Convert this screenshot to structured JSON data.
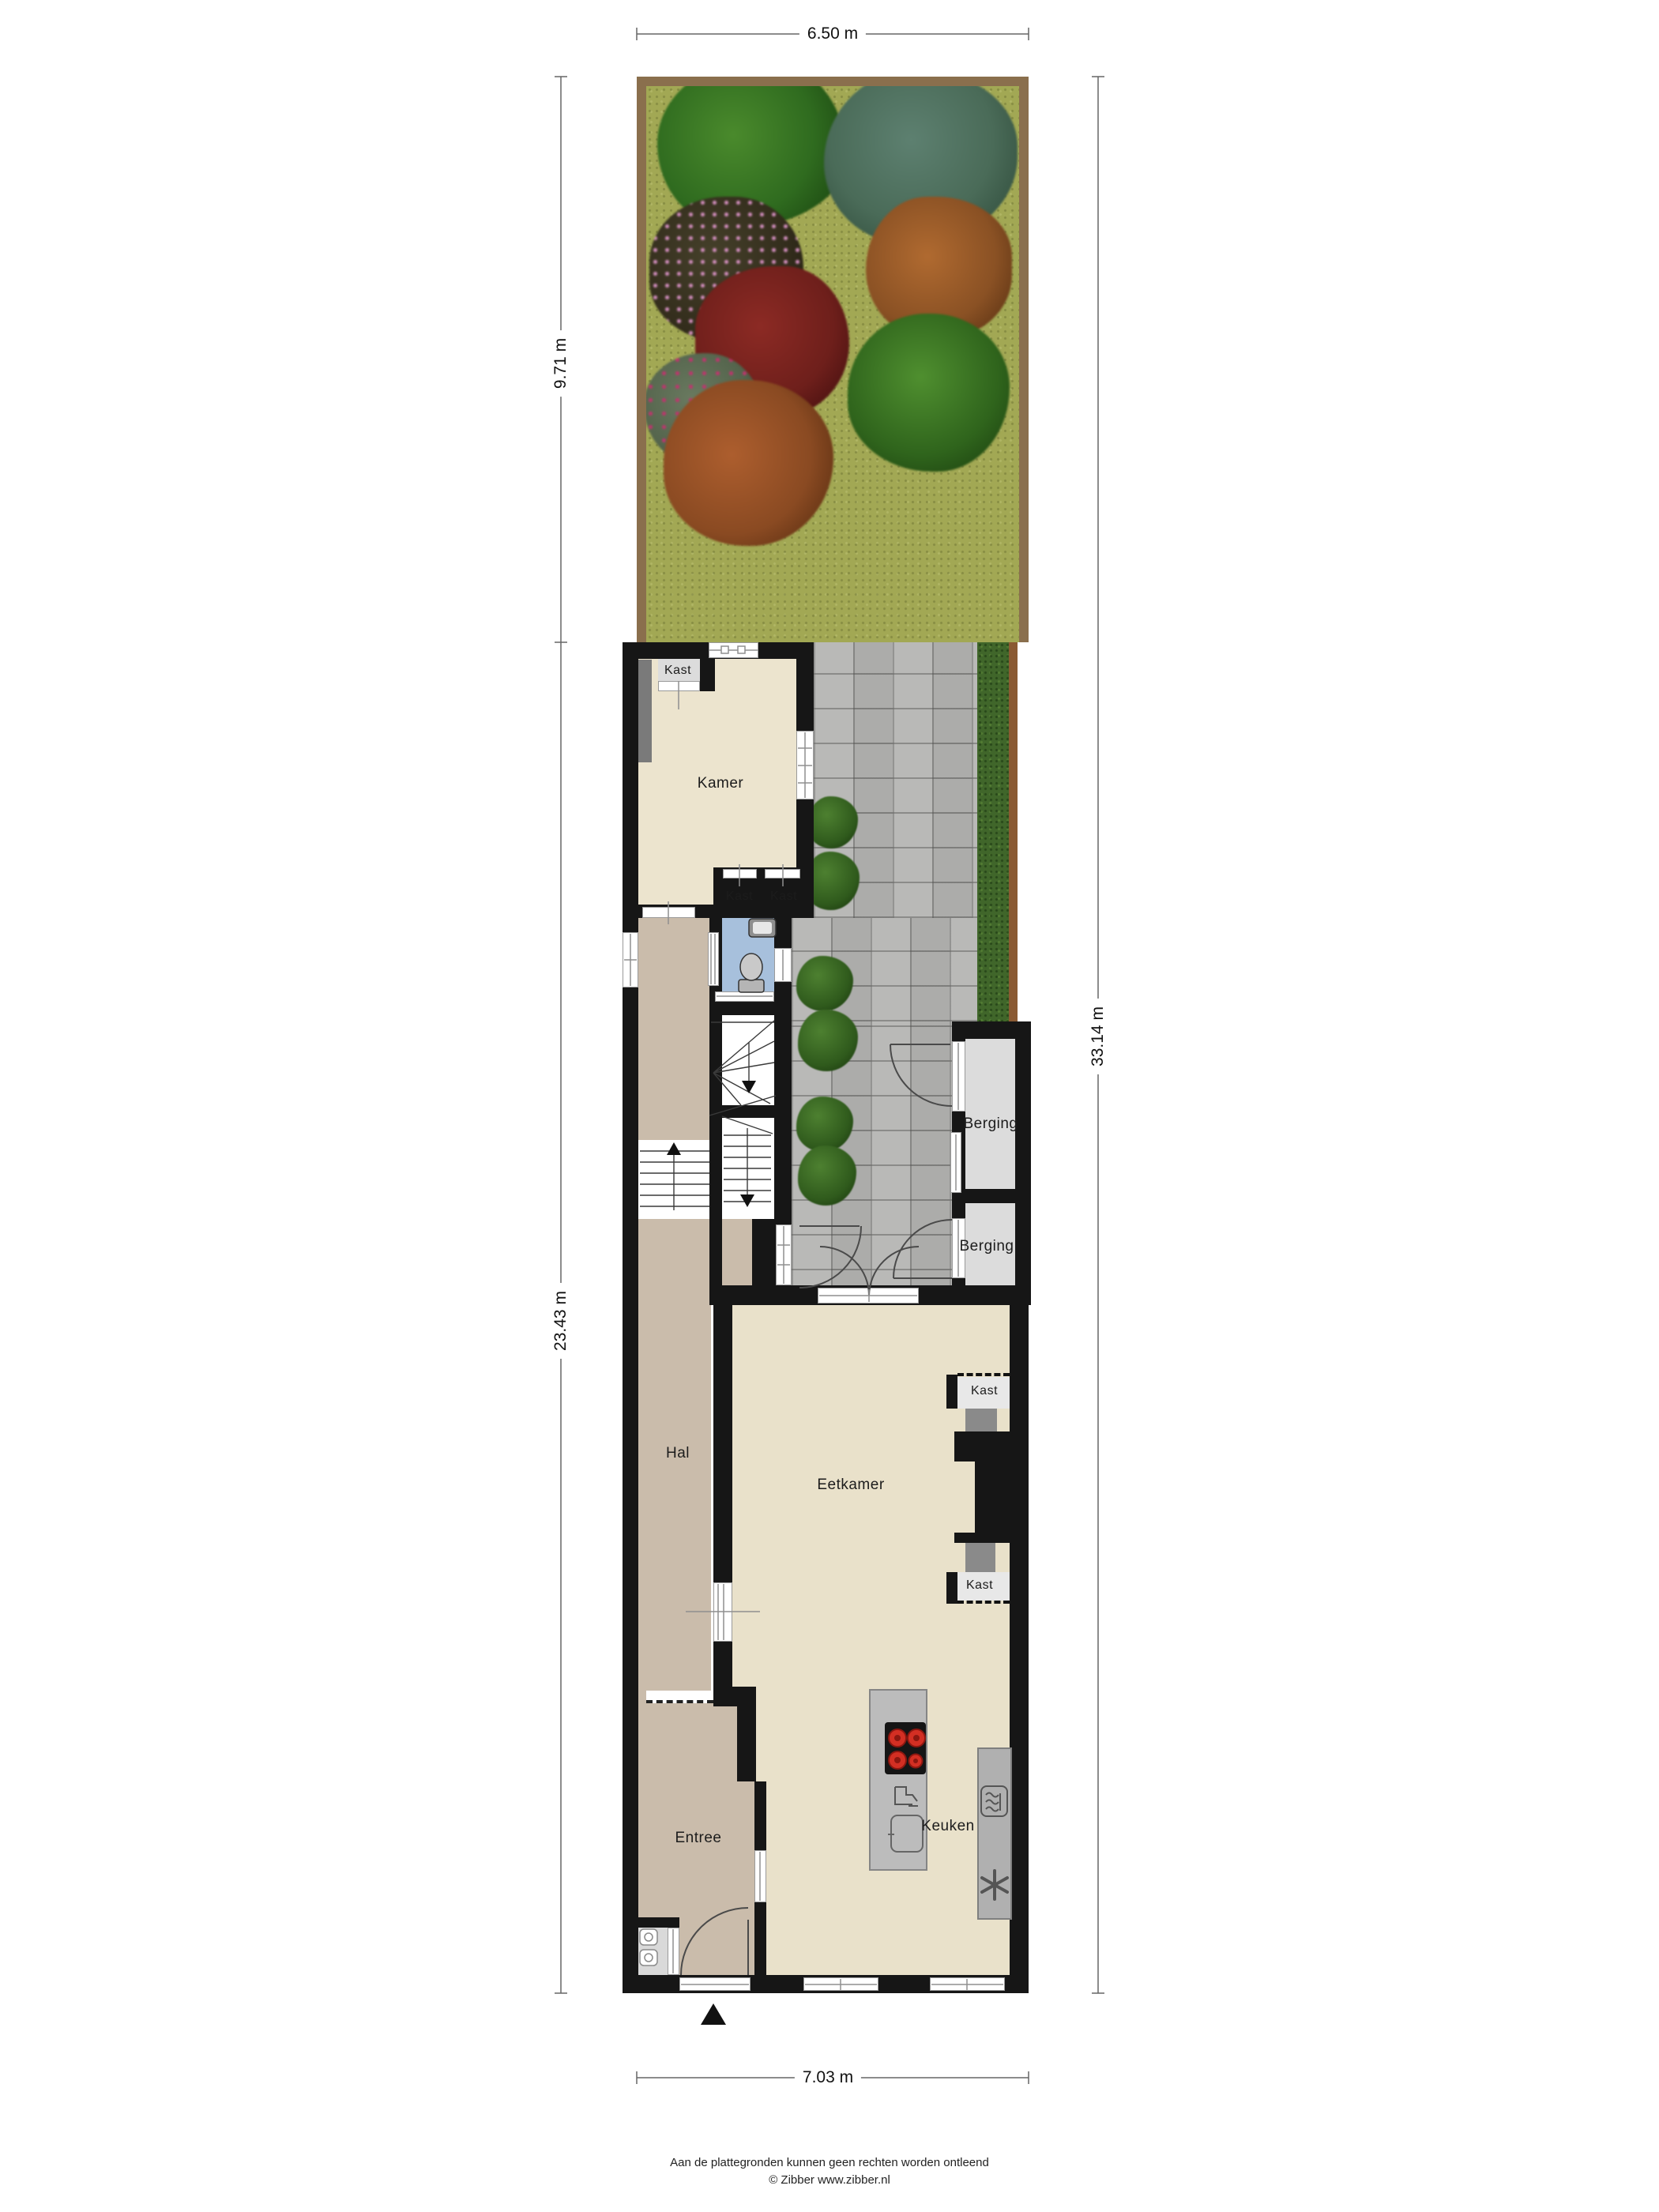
{
  "dimensions": {
    "top": "6.50 m",
    "garden_left": "9.71 m",
    "house_left": "23.43 m",
    "right_total": "33.14 m",
    "bottom": "7.03 m"
  },
  "rooms": {
    "kamer": "Kamer",
    "kast_top_left": "Kast",
    "kast_left": "Kast",
    "kast_right": "Kast",
    "berging_1": "Berging",
    "berging_2": "Berging",
    "hal": "Hal",
    "eetkamer": "Eetkamer",
    "kast_chimney_top": "Kast",
    "kast_chimney_bottom": "Kast",
    "keuken": "Keuken",
    "entree": "Entree"
  },
  "footer": {
    "disclaimer": "Aan de plattegronden kunnen geen rechten worden ontleend",
    "copyright": "© Zibber www.zibber.nl"
  },
  "colors": {
    "wall": "#161616",
    "room_beige": "#e9e1ca",
    "hall_tan": "#cabcab",
    "bath_blue": "#a7c0dc",
    "closet_grey": "#dcdcdc",
    "paver_grey": "#b5b5b3",
    "grass_green": "#a2a854",
    "hedge_green": "#40662a",
    "fence_brown": "#8a5a33",
    "burner_red": "#d32f23"
  }
}
